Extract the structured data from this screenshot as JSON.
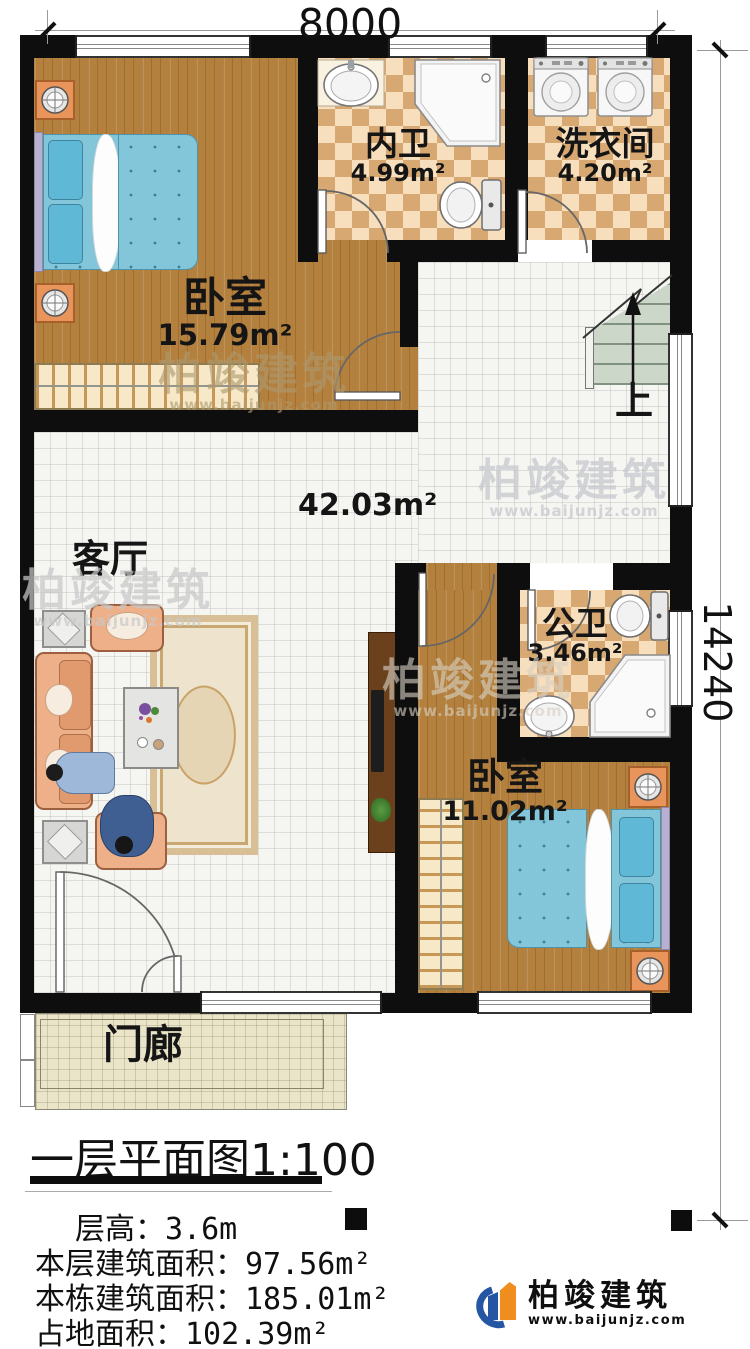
{
  "dimensions": {
    "width_mm": "8000",
    "height_mm": "14240"
  },
  "rooms": {
    "bedroom1": {
      "name": "卧室",
      "area": "15.79m²"
    },
    "bath_inner": {
      "name": "内卫",
      "area": "4.99m²"
    },
    "laundry": {
      "name": "洗衣间",
      "area": "4.20m²"
    },
    "living": {
      "name": "客厅",
      "area": "42.03m²"
    },
    "bath_public": {
      "name": "公卫",
      "area": "3.46m²"
    },
    "bedroom2": {
      "name": "卧室",
      "area": "11.02m²"
    },
    "porch": {
      "name": "门廊"
    }
  },
  "stairs": {
    "up_label": "上"
  },
  "title": {
    "text": "一层平面图",
    "scale": "1:100"
  },
  "info": {
    "rows": [
      {
        "label": "层高：",
        "value": "3.6m"
      },
      {
        "label": "本层建筑面积：",
        "value": "97.56m²"
      },
      {
        "label": "本栋建筑面积：",
        "value": "185.01m²"
      },
      {
        "label": "占地面积：",
        "value": "102.39m²"
      }
    ]
  },
  "watermark": {
    "company": "柏竣建筑",
    "website": "www.baijunjz.com"
  },
  "logo": {
    "company": "柏竣建筑",
    "website": "www.baijunjz.com"
  },
  "colors": {
    "wall": "#0e0e0e",
    "wood_floor": "#b4803e",
    "bath_tile_dark": "#d8a873",
    "bath_tile_light": "#f7debc",
    "bed_fabric": "#84c6d9",
    "sofa": "#edb088",
    "brand_blue": "#2456a4",
    "brand_orange": "#ef8d1f"
  }
}
